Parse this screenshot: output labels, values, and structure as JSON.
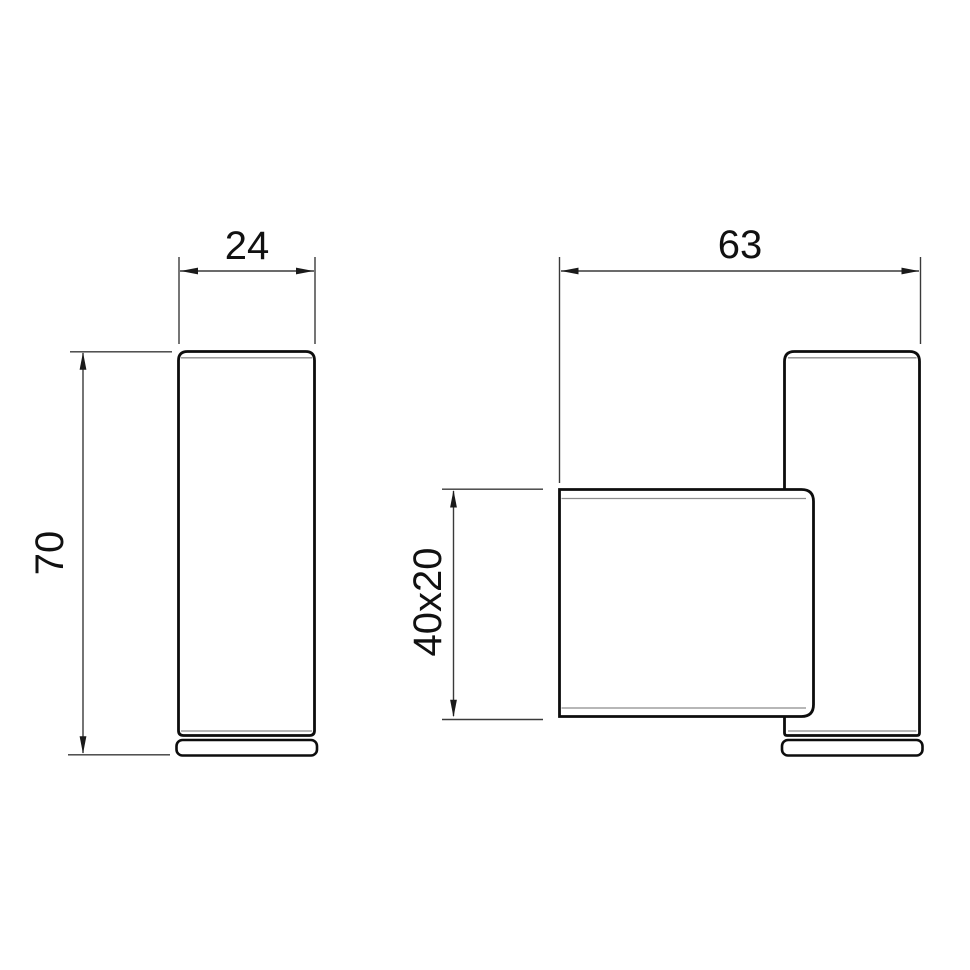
{
  "drawing": {
    "type": "technical-drawing",
    "colors": {
      "background": "#ffffff",
      "outline": "#0d0d0d",
      "edge_highlight": "#8c8c8c",
      "dimension_line": "#3a3a3a",
      "label_text": "#111111"
    },
    "views": [
      {
        "id": "front-view",
        "dimensions": [
          {
            "label": "24",
            "axis": "horizontal"
          },
          {
            "label": "70",
            "axis": "vertical"
          }
        ]
      },
      {
        "id": "side-view",
        "dimensions": [
          {
            "label": "63",
            "axis": "horizontal"
          },
          {
            "label": "40x20",
            "axis": "vertical"
          }
        ]
      }
    ]
  }
}
